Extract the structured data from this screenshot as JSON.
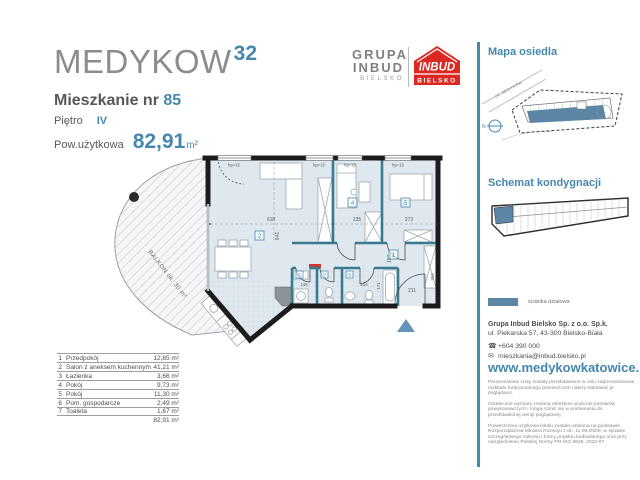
{
  "header": {
    "project_name": "MEDYKOW",
    "project_number": "32",
    "apartment_label": "Mieszkanie nr",
    "apartment_number": "85",
    "floor_label": "Piętro",
    "floor_value": "IV",
    "area_label": "Pow.użytkowa",
    "area_value": "82,91",
    "area_unit": "m²"
  },
  "logos": {
    "grupa_line1": "GRUPA",
    "grupa_line2": "INBUD",
    "grupa_line3": "BIELSKO",
    "inbud_line1": "INBUD",
    "inbud_line2": "BIELSKO"
  },
  "sidebar": {
    "map_title": "Mapa osiedla",
    "map_street_label": "UL. MEDYKÓW",
    "map_compass_label": "N",
    "schematic_title": "Schemat kondygnacji",
    "legend_label": "ścianka działowa",
    "company_name": "Grupa Inbud Bielsko Sp. z o.o. Sp.k.",
    "company_address": "ul. Piekarska 57, 43-300 Bielsko-Biała",
    "phone_icon": "☎",
    "email_icon": "✉",
    "phone": "+604 390 000",
    "email": "mieszkania@inbud.bielsko.pl",
    "website": "www.medykowkatowice.pl",
    "disclaimer_1": "Prezentowane rzuty zostały przedstawione w celu zaprezentowania rozkładu funkcjonalnego pomieszczeń należy traktować je poglądowo.",
    "disclaimer_2": "Ostateczne wymiary zostaną określone podczas pomiarów powykonawczych i mogą różnić się w porównaniu do przedstawionej wersji poglądowej.",
    "disclaimer_3": "Powierzchnia użytkowa lokalu została ustalona na podstawie Rozporządzenia Ministra Rozwoju z dn. 11.09.2020r. w sprawie szczegółowego zakresu i formy projektu budowlanego oraz przy uwzględnieniu Polskiej Normy PN-ISO 9836: 2022-07"
  },
  "floor_plan": {
    "balcony_label": "BALKON ok. 30 m²",
    "window_sill_label": "hp=15",
    "room_numbers": [
      "1",
      "2",
      "3",
      "4",
      "5",
      "6",
      "7"
    ],
    "dims": {
      "salon_width": "618",
      "salon_height": "641",
      "room4_width": "235",
      "room5_width": "273",
      "hall_height": "153",
      "room6_width": "146",
      "bath_width": "214",
      "bath_height": "171",
      "entry_width": "211",
      "hall_right_height": "306"
    }
  },
  "rooms_table": {
    "rows": [
      {
        "no": "1",
        "name": "Przedpokój",
        "area": "12,85 m²"
      },
      {
        "no": "2",
        "name": "Salon z aneksem kuchennym",
        "area": "41,21 m²"
      },
      {
        "no": "3",
        "name": "Łazienka",
        "area": "3,66 m²"
      },
      {
        "no": "4",
        "name": "Pokój",
        "area": "9,73 m²"
      },
      {
        "no": "5",
        "name": "Pokój",
        "area": "11,30 m²"
      },
      {
        "no": "6",
        "name": "Pom. gospodarcze",
        "area": "2,49 m²"
      },
      {
        "no": "7",
        "name": "Toaleta",
        "area": "1,67 m²"
      }
    ],
    "total_area": "82,91 m²"
  },
  "colors": {
    "accent": "#4587ae",
    "logo_red": "#dd2822",
    "partition_wall": "#3b7b92",
    "floor_fill": "#dfe8ee",
    "highlight_unit": "#5b87a5"
  }
}
